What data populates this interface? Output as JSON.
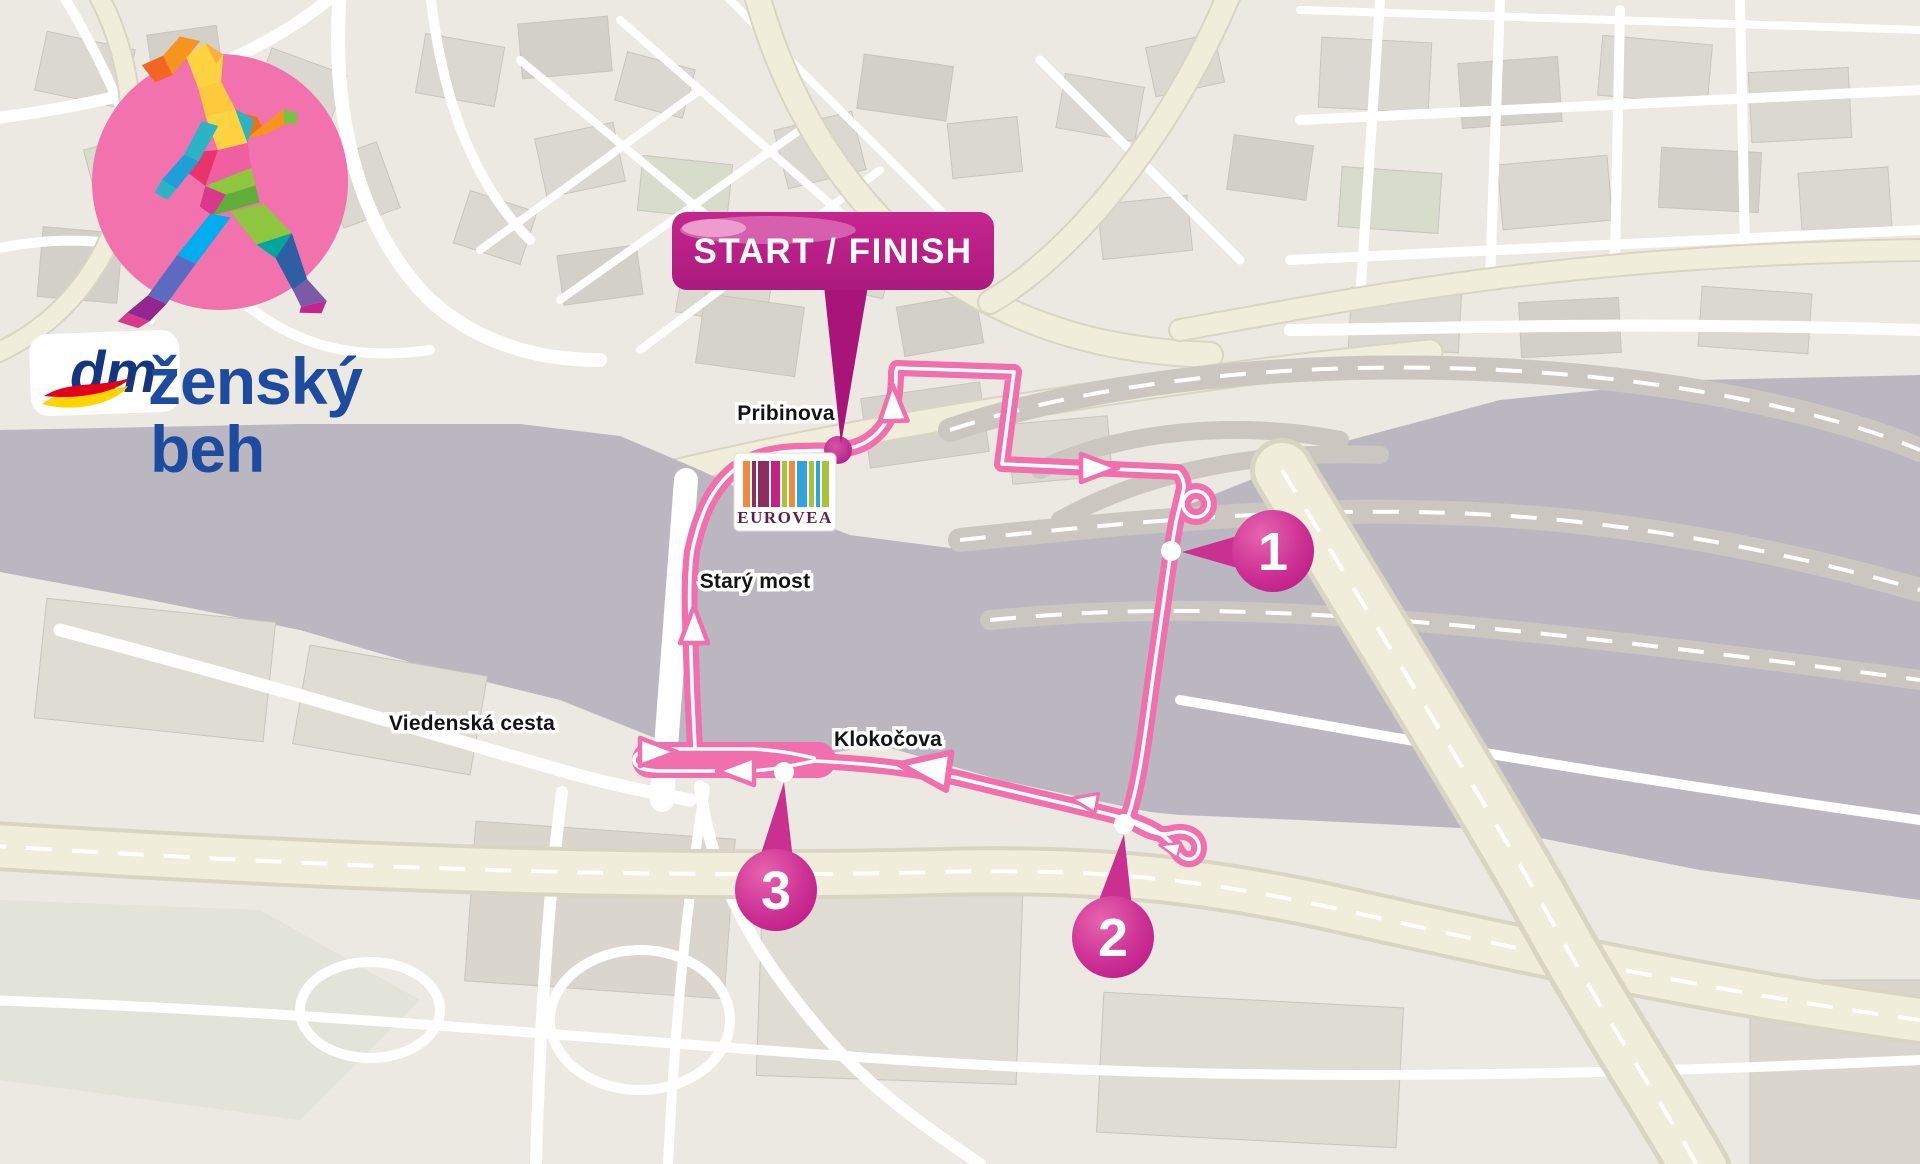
{
  "branding": {
    "dm_text": "dm",
    "title_line1": "ženský",
    "title_line2": "beh"
  },
  "banner": {
    "label": "START / FINISH"
  },
  "venue": {
    "name": "EUROVEA"
  },
  "street_labels": {
    "pribinova": "Pribinova",
    "stary_most": "Starý most",
    "viedenska_cesta": "Viedenská cesta",
    "klokocova": "Klokočova"
  },
  "markers": [
    {
      "label": "1"
    },
    {
      "label": "2"
    },
    {
      "label": "3"
    }
  ],
  "colors": {
    "route_pink": "#F16FAD",
    "marker_magenta": "#BE1D87",
    "banner_magenta": "#B51C82",
    "river_gray": "#BAB7C1",
    "land_beige": "#ECE9E2",
    "building_gray": "#DBD7D1",
    "road_beige": "#F0EDDA",
    "title_blue": "#1C4BA0",
    "logo_circle_pink": "#F272AE"
  }
}
